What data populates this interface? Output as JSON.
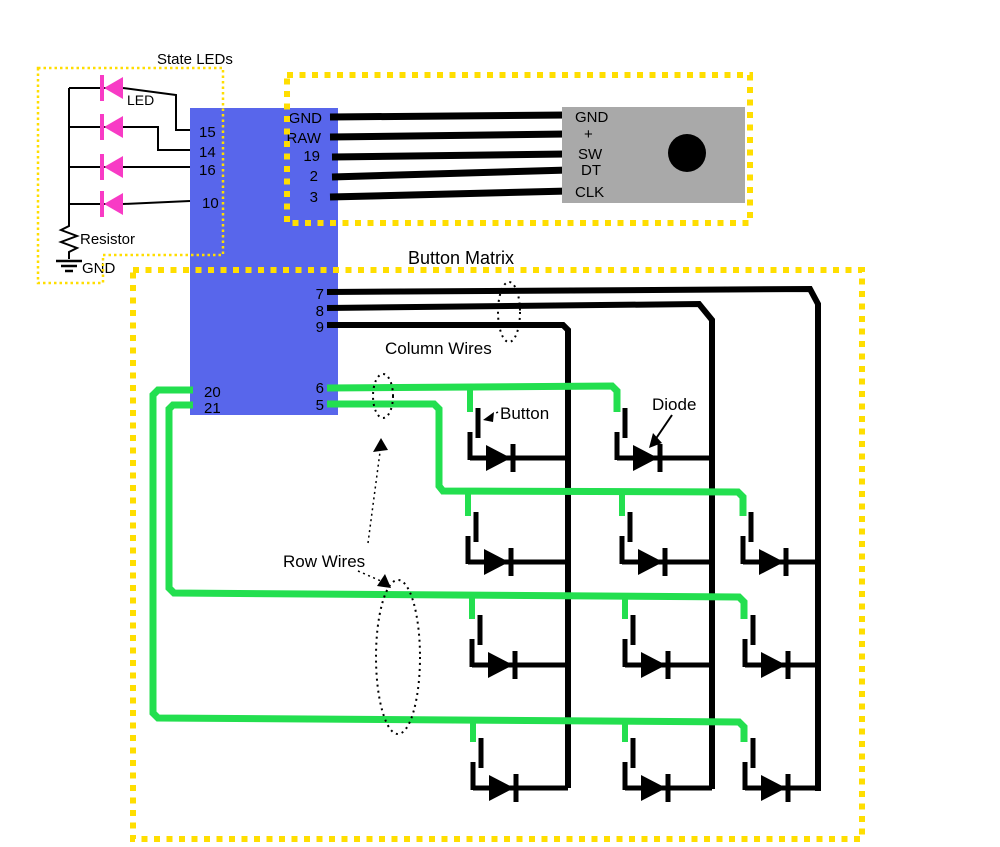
{
  "state_leds": {
    "title": "State LEDs",
    "led_label": "LED",
    "resistor_label": "Resistor",
    "ground_label": "GND",
    "pin_labels": [
      "15",
      "14",
      "16",
      "10"
    ]
  },
  "mcu": {
    "encoder_pins": [
      "GND",
      "RAW",
      "19",
      "2",
      "3"
    ],
    "column_pins": [
      "7",
      "8",
      "9"
    ],
    "row_pins_right": [
      "6",
      "5"
    ],
    "row_pins_left": [
      "20",
      "21"
    ]
  },
  "rotary_encoder": {
    "pin_labels": [
      "GND",
      "+",
      "SW",
      "DT",
      "CLK"
    ]
  },
  "button_matrix": {
    "title": "Button Matrix",
    "column_wires_label": "Column Wires",
    "row_wires_label": "Row Wires",
    "button_label": "Button",
    "diode_label": "Diode"
  },
  "colors": {
    "mcu_board_blue": "#5866EB",
    "row_wire_green": "#23DF4F",
    "led_magenta": "#F83BC5",
    "section_border_yellow": "#FFDE00",
    "encoder_gray": "#A9A9A9",
    "wire_black": "#000000"
  }
}
